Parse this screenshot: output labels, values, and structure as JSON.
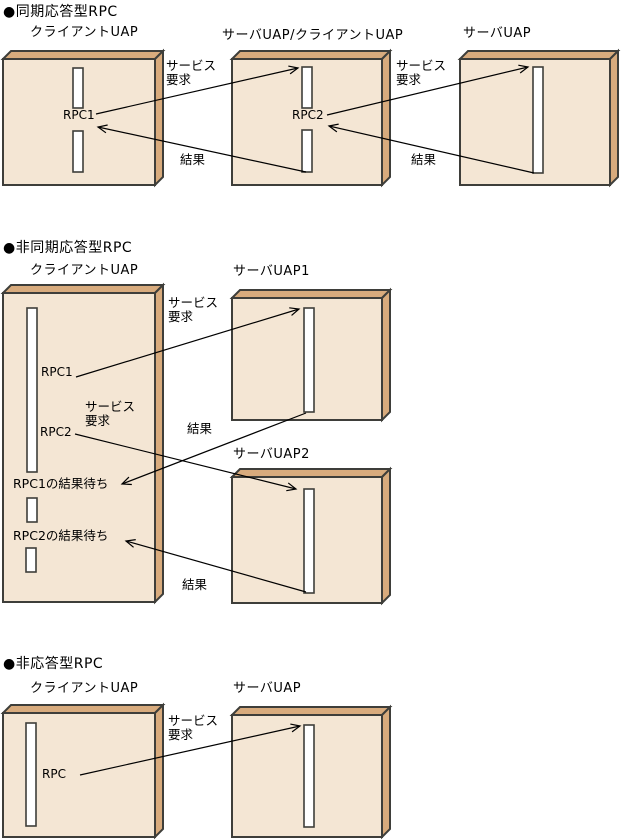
{
  "colors": {
    "box_face": "#f4e6d4",
    "box_bevel": "#d8ab7d",
    "outline": "#3e3e3a",
    "slot_fill": "#ffffff",
    "arrow": "#000000",
    "background": "#ffffff"
  },
  "sections": [
    {
      "heading": "●同期応答型RPC",
      "client_title": "クライアントUAP",
      "middle_title": "サーバUAP/クライアントUAP",
      "server_title": "サーバUAP",
      "rpc1": "RPC1",
      "rpc2": "RPC2",
      "svc1_l1": "サービス",
      "svc1_l2": "要求",
      "result1": "結果",
      "svc2_l1": "サービス",
      "svc2_l2": "要求",
      "result2": "結果"
    },
    {
      "heading": "●非同期応答型RPC",
      "client_title": "クライアントUAP",
      "server1_title": "サーバUAP1",
      "server2_title": "サーバUAP2",
      "rpc1": "RPC1",
      "rpc2": "RPC2",
      "wait1": "RPC1の結果待ち",
      "wait2": "RPC2の結果待ち",
      "svc1_l1": "サービス",
      "svc1_l2": "要求",
      "svc2_l1": "サービス",
      "svc2_l2": "要求",
      "result1": "結果",
      "result2": "結果"
    },
    {
      "heading": "●非応答型RPC",
      "client_title": "クライアントUAP",
      "server_title": "サーバUAP",
      "rpc": "RPC",
      "svc_l1": "サービス",
      "svc_l2": "要求"
    }
  ]
}
